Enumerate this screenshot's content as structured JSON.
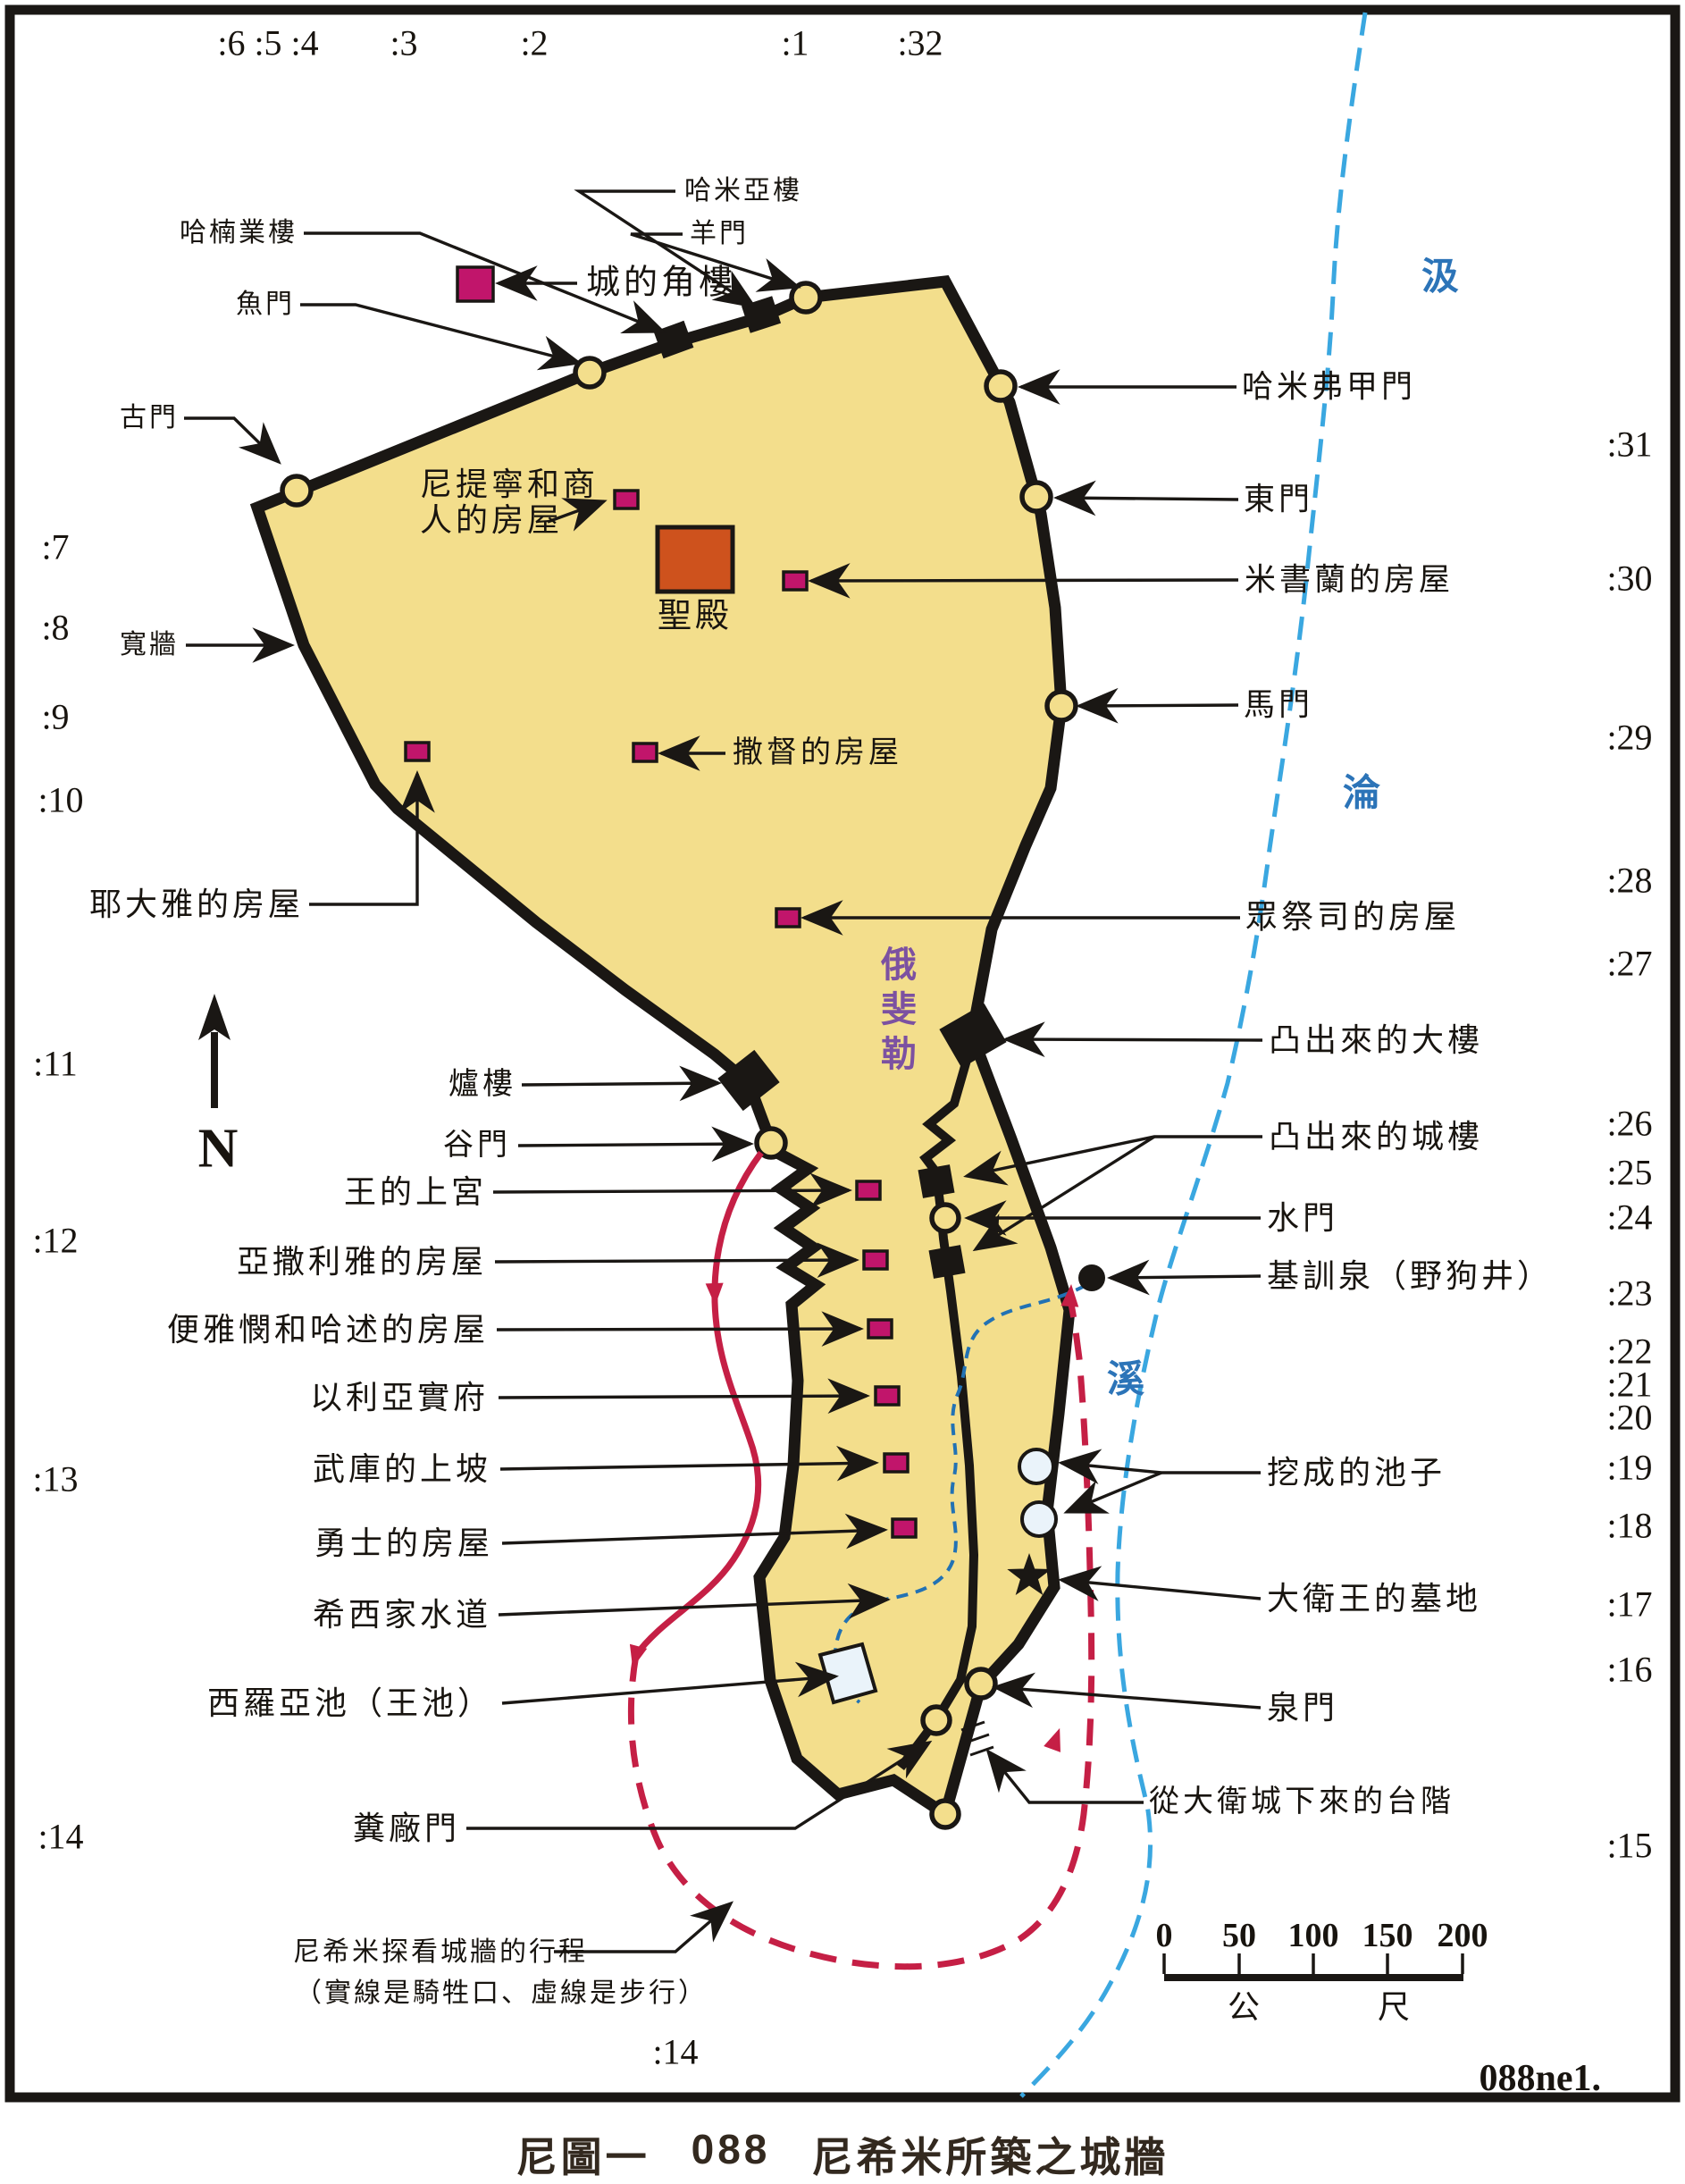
{
  "caption": {
    "prefix": "尼圖一",
    "number": "088",
    "title": "尼希米所築之城牆"
  },
  "map_code": "088ne1.",
  "compass_n": "N",
  "verses": {
    "top": [
      ":6 :5 :4",
      ":3",
      ":2",
      ":1",
      ":32"
    ],
    "left": [
      ":7",
      ":8",
      ":9",
      ":10",
      ":11",
      ":12",
      ":13",
      ":14"
    ],
    "right": [
      ":31",
      ":30",
      ":29",
      ":28",
      ":27",
      ":26",
      ":25",
      ":24",
      ":23",
      ":22",
      ":21",
      ":20",
      ":19",
      ":18",
      ":17",
      ":16",
      ":15"
    ],
    "bottom": ":14"
  },
  "labels": {
    "tower_hananel": "哈楠業樓",
    "fish_gate": "魚門",
    "tower_hammeah": "哈米亞樓",
    "sheep_gate": "羊門",
    "old_gate": "古門",
    "broad_wall": "寬牆",
    "nethinim_merchants_houses": "尼提寧和商\n人的房屋",
    "corner_tower": "城的角樓",
    "temple": "聖殿",
    "meshullam_house": "米書蘭的房屋",
    "hammiphkad_gate": "哈米弗甲門",
    "east_gate": "東門",
    "horse_gate": "馬門",
    "zadok_house": "撒督的房屋",
    "jedaiah_house": "耶大雅的房屋",
    "priests_houses": "眾祭司的房屋",
    "projecting_great_tower": "凸出來的大樓",
    "projecting_towers": "凸出來的城樓",
    "water_gate": "水門",
    "gihon_spring": "基訓泉（野狗井）",
    "kings_upper_palace": "王的上宮",
    "azariah_house": "亞撒利雅的房屋",
    "benjamin_hasshub_houses": "便雅憫和哈述的房屋",
    "eliashib_house": "以利亞實府",
    "armory_ascent": "武庫的上坡",
    "mighty_men_houses": "勇士的房屋",
    "hezekiah_conduit": "希西家水道",
    "siloam_pool": "西羅亞池（王池）",
    "dung_gate": "糞廠門",
    "hewn_pools": "挖成的池子",
    "david_tombs": "大衛王的墓地",
    "fountain_gate": "泉門",
    "steps_from_city_of_david": "從大衛城下來的台階",
    "tower_furnaces": "爐樓",
    "valley_gate": "谷門",
    "ophel": "俄斐勒"
  },
  "legend": {
    "line1": "尼希米探看城牆的行程",
    "line2": "（實線是騎牲口、虛線是步行）"
  },
  "river": {
    "chars": [
      "汲",
      "淪",
      "溪"
    ]
  },
  "scale_bar": {
    "ticks": [
      "0",
      "50",
      "100",
      "150",
      "200"
    ],
    "unit_left": "公",
    "unit_right": "尺"
  },
  "colors": {
    "city_fill": "#F3DE8C",
    "wall": "#1A1714",
    "house": "#C1156B",
    "temple": "#CE521D",
    "river": "#3AA7E0",
    "river_text": "#2C74B8",
    "tunnel": "#2272B4",
    "route": "#C51F45",
    "ophel_text": "#7C51A1",
    "pool_fill": "#EAF3FA"
  }
}
